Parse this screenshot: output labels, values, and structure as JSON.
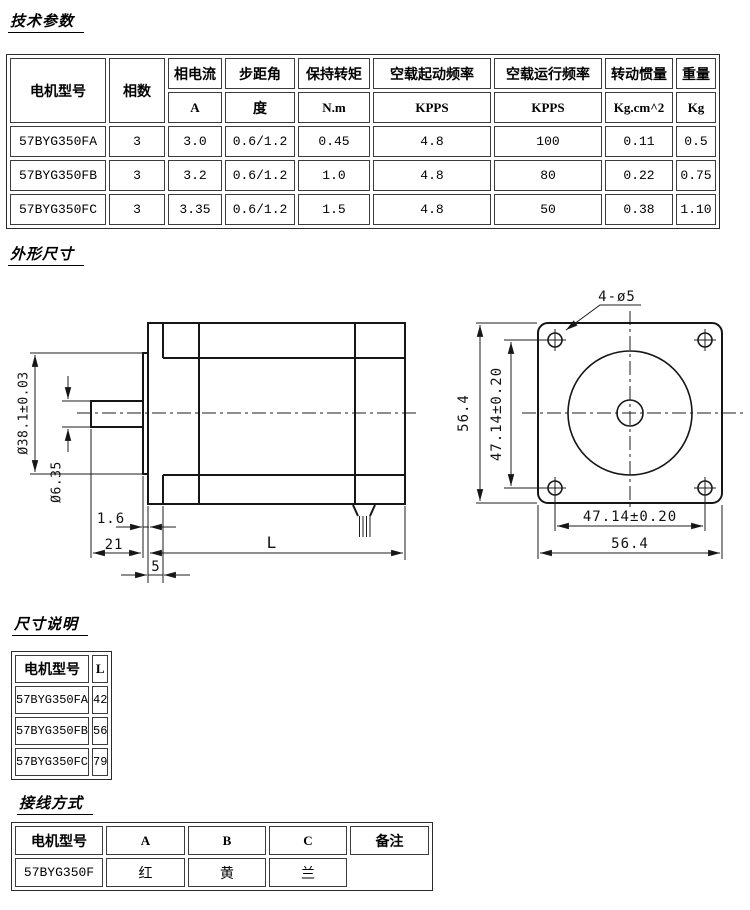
{
  "titles": {
    "tech_params": "技术参数",
    "outline_dimensions": "外形尺寸",
    "dimension_note": "尺寸说明",
    "wiring_method": "接线方式"
  },
  "spec_table": {
    "headers": [
      "电机型号",
      "相数",
      "相电流",
      "步距角",
      "保持转矩",
      "空载起动频率",
      "空载运行频率",
      "转动惯量",
      "重量"
    ],
    "units": [
      "A",
      "度",
      "N.m",
      "KPPS",
      "KPPS",
      "Kg.cm^2",
      "Kg"
    ],
    "rows": [
      [
        "57BYG350FA",
        "3",
        "3.0",
        "0.6/1.2",
        "0.45",
        "4.8",
        "100",
        "0.11",
        "0.5"
      ],
      [
        "57BYG350FB",
        "3",
        "3.2",
        "0.6/1.2",
        "1.0",
        "4.8",
        "80",
        "0.22",
        "0.75"
      ],
      [
        "57BYG350FC",
        "3",
        "3.35",
        "0.6/1.2",
        "1.5",
        "4.8",
        "50",
        "0.38",
        "1.10"
      ]
    ]
  },
  "drawings": {
    "side_view": {
      "boss_diameter": "Ø38.1±0.03",
      "shaft_diameter": "Ø6.35",
      "flange_thickness": "1.6",
      "shaft_length": "21",
      "pilot_depth": "5",
      "body_length": "L"
    },
    "front_view": {
      "mount_holes": "4-ø5",
      "frame_height": "56.4",
      "hole_spacing_vertical": "47.14±0.20",
      "hole_spacing_horizontal": "47.14±0.20",
      "frame_width": "56.4"
    }
  },
  "dim_table": {
    "headers": [
      "电机型号",
      "L"
    ],
    "rows": [
      [
        "57BYG350FA",
        "42"
      ],
      [
        "57BYG350FB",
        "56"
      ],
      [
        "57BYG350FC",
        "79"
      ]
    ]
  },
  "wiring_table": {
    "headers": [
      "电机型号",
      "A",
      "B",
      "C",
      "备注"
    ],
    "rows": [
      [
        "57BYG350F",
        "红",
        "黄",
        "兰",
        ""
      ]
    ]
  }
}
